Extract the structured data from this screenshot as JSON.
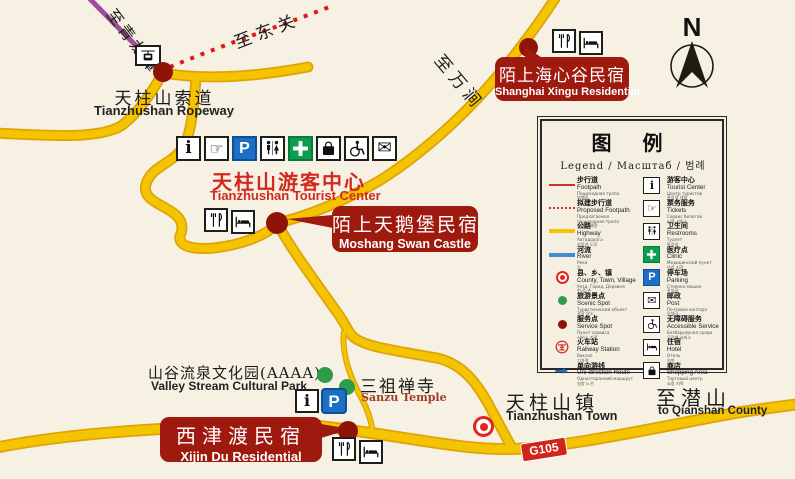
{
  "colors": {
    "background": "#f6f1e2",
    "road_yellow": "#f5c400",
    "road_casing": "#dea307",
    "ropeway_purple": "#9c4f98",
    "footpath_red": "#d03025",
    "badge_red": "#9e1a0f",
    "label_red": "#d2281e",
    "service_dot": "#8e1408",
    "scenic_green": "#2e9c49",
    "parking_blue": "#1b6fc4",
    "clinic_green": "#0a9e4e",
    "g105_red": "#d0251b"
  },
  "compass": {
    "label": "N"
  },
  "places": {
    "ropeway": {
      "zh": "天柱山索道",
      "en": "Tianzhushan Ropeway"
    },
    "tourist_center": {
      "zh": "天柱山游客中心",
      "en": "Tianzhushan Tourist Center"
    },
    "moshang": {
      "zh": "陌上天鹅堡民宿",
      "en": "Moshang Swan Castle"
    },
    "shanghai_xingu": {
      "zh": "陌上海心谷民宿",
      "en": "Shanghai Xingu Residential"
    },
    "xijin": {
      "zh": "西津渡民宿",
      "en": "Xijin Du Residential"
    },
    "valley": {
      "zh": "山谷流泉文化园(AAAA)",
      "en": "Valley Stream Cultural Park"
    },
    "sanzu": {
      "zh": "三祖禅寺",
      "en": "Sanzu Temple"
    },
    "town": {
      "zh": "天柱山镇",
      "en": "Tianzhushan Town"
    },
    "qianshan": {
      "zh": "至潜山",
      "en": "to Qianshan County"
    },
    "to_qinglongtan": "至青龙潭",
    "to_dongguan": "至东关",
    "to_wanjian": "至万涧",
    "g105": "G105"
  },
  "icons": {
    "info_glyph": "i",
    "parking_glyph": "P",
    "tickets_glyph": "☞",
    "mail_glyph": "✉"
  },
  "legend": {
    "title": "图 例",
    "subtitle": "Legend / Масштаб / 범례",
    "left": [
      {
        "zh": "步行道",
        "en": "Footpath",
        "ru": "Пешеходная тропа",
        "ko": "보행로",
        "symbol": "red-line"
      },
      {
        "zh": "拟建步行道",
        "en": "Proposed Footpath",
        "ru": "Предлагаемая пешеходная тропа",
        "ko": "보행로 예정",
        "symbol": "red-dotted-line"
      },
      {
        "zh": "公路",
        "en": "Highway",
        "ru": "Автодорога",
        "ko": "자동차 도로",
        "symbol": "yellow-line"
      },
      {
        "zh": "河流",
        "en": "River",
        "ru": "Река",
        "ko": "강",
        "symbol": "blue-line"
      },
      {
        "zh": "县、乡、镇",
        "en": "County, Town, Village",
        "ru": "Уезд, Город, Деревня",
        "ko": "현,읍,촌",
        "symbol": "red-ring"
      },
      {
        "zh": "旅游景点",
        "en": "Scenic Spot",
        "ru": "Туристический объект",
        "ko": "관광 명소",
        "symbol": "green-dot"
      },
      {
        "zh": "服务点",
        "en": "Service Spot",
        "ru": "Пункт сервиса",
        "ko": "서비스 지점",
        "symbol": "maroon-dot"
      },
      {
        "zh": "火车站",
        "en": "Railway Station",
        "ru": "Вокзал",
        "ko": "기차역",
        "symbol": "railway-logo"
      },
      {
        "zh": "单向游线",
        "en": "Uni-direction Route",
        "ru": "Односторонний маршрут",
        "ko": "일방 노선",
        "symbol": "blue-arrow"
      }
    ],
    "right": [
      {
        "zh": "游客中心",
        "en": "Tourist Center",
        "ru": "Центр туристов",
        "ko": "관광객 센터",
        "icon": "info"
      },
      {
        "zh": "票务服务",
        "en": "Tickets",
        "ru": "Сервис билетов",
        "ko": "티켓 서비스",
        "icon": "tickets-hand"
      },
      {
        "zh": "卫生间",
        "en": "Restrooms",
        "ru": "Туалет",
        "ko": "화장실",
        "icon": "restrooms"
      },
      {
        "zh": "医疗点",
        "en": "Clinic",
        "ru": "Медицинский пункт",
        "ko": "의료 지점",
        "icon": "clinic"
      },
      {
        "zh": "停车场",
        "en": "Parking",
        "ru": "Стоянка машин",
        "ko": "주차장",
        "icon": "parking"
      },
      {
        "zh": "邮政",
        "en": "Post",
        "ru": "Почтовая контора",
        "ko": "우체국",
        "icon": "mail"
      },
      {
        "zh": "无障碍服务",
        "en": "Accessible Service",
        "ru": "Безбарьерная среда",
        "ko": "무장애 서비스",
        "icon": "accessible"
      },
      {
        "zh": "住宿",
        "en": "Hotel",
        "ru": "Отель",
        "ko": "숙박",
        "icon": "hotel-bed"
      },
      {
        "zh": "商店",
        "en": "Shopping Area",
        "ru": "Торговый центр",
        "ko": "쇼핑 지역",
        "icon": "shopping"
      }
    ]
  }
}
